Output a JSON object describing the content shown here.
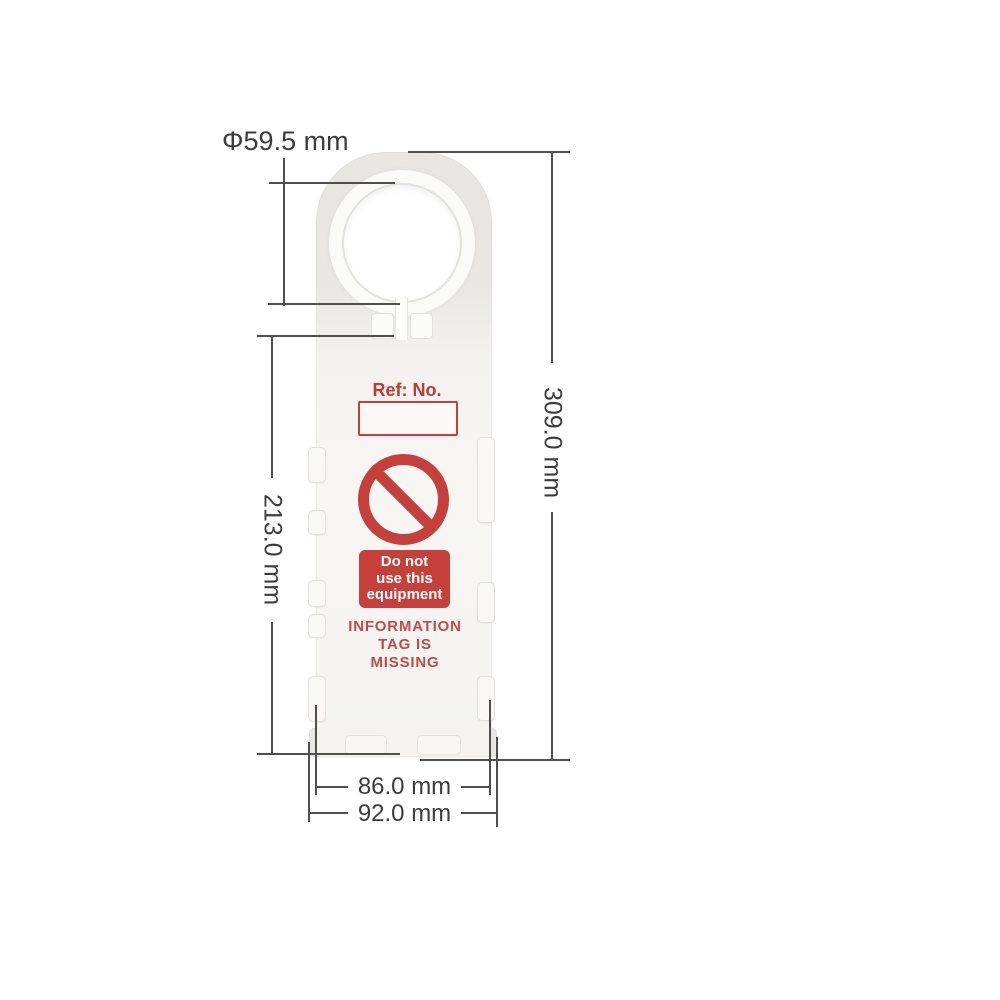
{
  "diagram_title": "Scaffolding tag holder dimension drawing",
  "dimensions": {
    "hole_diameter": "Φ59.5 mm",
    "overall_height": "309.0 mm",
    "body_height": "213.0 mm",
    "inner_width": "86.0 mm",
    "outer_width": "92.0 mm"
  },
  "tag": {
    "ref_label": "Ref: No.",
    "prohibition_lines": [
      "Do not",
      "use this",
      "equipment"
    ],
    "warning_lines": [
      "INFORMATION",
      "TAG IS",
      "MISSING"
    ]
  },
  "colors": {
    "red": "#c5403a",
    "red_dark": "#b93d38",
    "red_light": "#c34a44",
    "dimension_line": "#4f4f4f",
    "dimension_text": "#3c3c3c",
    "tag_top_shade": "#e8e6e3",
    "tag_body": "#f6f5f2",
    "background": "#ffffff"
  }
}
